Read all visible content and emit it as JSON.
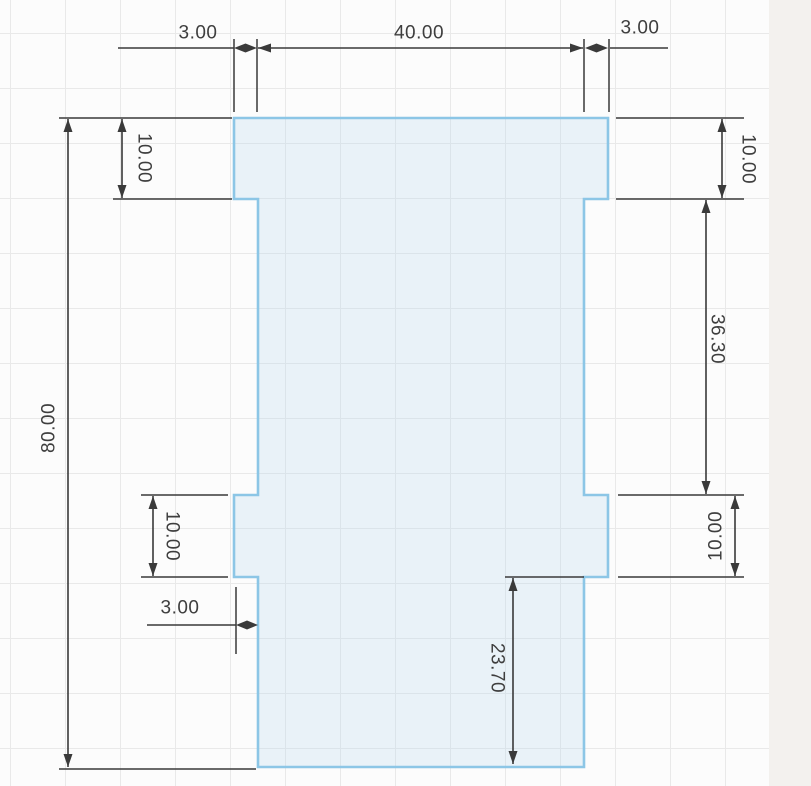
{
  "canvas": {
    "width": 811,
    "height": 786,
    "background_color": "#fcfcfc",
    "grid_color": "#e9e9e9",
    "grid_size": 55,
    "grid_offset_x": 10,
    "grid_offset_y": 33,
    "right_edge_panel_color": "#f3f1ee"
  },
  "sketch": {
    "stroke_color": "#8cc6e6",
    "stroke_width": 2.6,
    "fill_color": "rgba(184,214,238,0.28)",
    "profile_points": "234,118 608,118 608,199 584,199 584,495 608,495 608,577 584,577 584,767 258,767 258,577 234,577 234,495 258,495 258,199 234,199"
  },
  "dimension_style": {
    "line_color": "#3a3a3a",
    "line_width": 1.6,
    "ext_line_width": 1.5,
    "text_color": "#3e3e3e",
    "font_size": 19,
    "arrow_len": 13,
    "arrow_half_w": 4.5
  },
  "dimensions": [
    {
      "id": "top-left-3",
      "label": "3.00",
      "text": {
        "x": 198,
        "y": 33,
        "rot": 0
      },
      "plain_lines": [
        [
          118,
          48,
          234,
          48
        ]
      ],
      "diamond": {
        "x1": 234,
        "x2": 257,
        "y": 48
      },
      "ext_lines": [
        [
          234,
          39,
          234,
          112
        ],
        [
          257,
          39,
          257,
          112
        ]
      ]
    },
    {
      "id": "top-40",
      "label": "40.00",
      "text": {
        "x": 419,
        "y": 33,
        "rot": 0
      },
      "arrow_line": {
        "x1": 258,
        "y1": 48,
        "x2": 583,
        "y2": 48
      },
      "ext_lines": [
        [
          584,
          39,
          584,
          112
        ],
        [
          609,
          39,
          609,
          112
        ]
      ]
    },
    {
      "id": "top-right-3",
      "label": "3.00",
      "text": {
        "x": 640,
        "y": 28,
        "rot": 0
      },
      "plain_lines": [
        [
          610,
          48,
          668,
          48
        ]
      ],
      "diamond": {
        "x1": 585,
        "x2": 608,
        "y": 48
      },
      "ext_lines": []
    },
    {
      "id": "left-80",
      "label": "80.00",
      "text": {
        "x": 49,
        "y": 428,
        "rot": -90
      },
      "arrow_line": {
        "x1": 68,
        "y1": 119,
        "x2": 68,
        "y2": 767
      },
      "ext_lines": [
        [
          59,
          118,
          232,
          118
        ],
        [
          59,
          769,
          256,
          769
        ]
      ]
    },
    {
      "id": "top-left-10",
      "label": "10.00",
      "text": {
        "x": 144,
        "y": 158,
        "rot": 90
      },
      "arrow_line": {
        "x1": 122,
        "y1": 119,
        "x2": 122,
        "y2": 198
      },
      "ext_lines": [
        [
          113,
          199,
          232,
          199
        ]
      ]
    },
    {
      "id": "top-right-10",
      "label": "10.00",
      "text": {
        "x": 748,
        "y": 159,
        "rot": 90
      },
      "arrow_line": {
        "x1": 722,
        "y1": 119,
        "x2": 722,
        "y2": 198
      },
      "ext_lines": [
        [
          616,
          118,
          744,
          118
        ],
        [
          616,
          199,
          744,
          199
        ]
      ]
    },
    {
      "id": "right-36-30",
      "label": "36.30",
      "text": {
        "x": 717,
        "y": 339,
        "rot": 90
      },
      "arrow_line": {
        "x1": 706,
        "y1": 200,
        "x2": 706,
        "y2": 494
      },
      "ext_lines": [
        [
          618,
          495,
          744,
          495
        ]
      ]
    },
    {
      "id": "mid-right-10",
      "label": "10.00",
      "text": {
        "x": 716,
        "y": 536,
        "rot": -90
      },
      "arrow_line": {
        "x1": 735,
        "y1": 496,
        "x2": 735,
        "y2": 576
      },
      "ext_lines": [
        [
          618,
          577,
          744,
          577
        ]
      ]
    },
    {
      "id": "mid-left-10",
      "label": "10.00",
      "text": {
        "x": 172,
        "y": 536,
        "rot": 90
      },
      "arrow_line": {
        "x1": 153,
        "y1": 496,
        "x2": 153,
        "y2": 576
      },
      "ext_lines": [
        [
          141,
          495,
          228,
          495
        ],
        [
          141,
          577,
          228,
          577
        ]
      ]
    },
    {
      "id": "bottom-left-3",
      "label": "3.00",
      "text": {
        "x": 180,
        "y": 608,
        "rot": 0
      },
      "plain_lines": [
        [
          147,
          625,
          236,
          625
        ]
      ],
      "diamond": {
        "x1": 236,
        "x2": 258,
        "y": 625
      },
      "ext_lines": [
        [
          236,
          587,
          236,
          654
        ]
      ]
    },
    {
      "id": "bottom-23-70",
      "label": "23.70",
      "text": {
        "x": 497,
        "y": 668,
        "rot": 90
      },
      "arrow_line": {
        "x1": 513,
        "y1": 578,
        "x2": 513,
        "y2": 764
      },
      "ext_lines": [
        [
          505,
          577,
          584,
          577
        ]
      ]
    }
  ]
}
